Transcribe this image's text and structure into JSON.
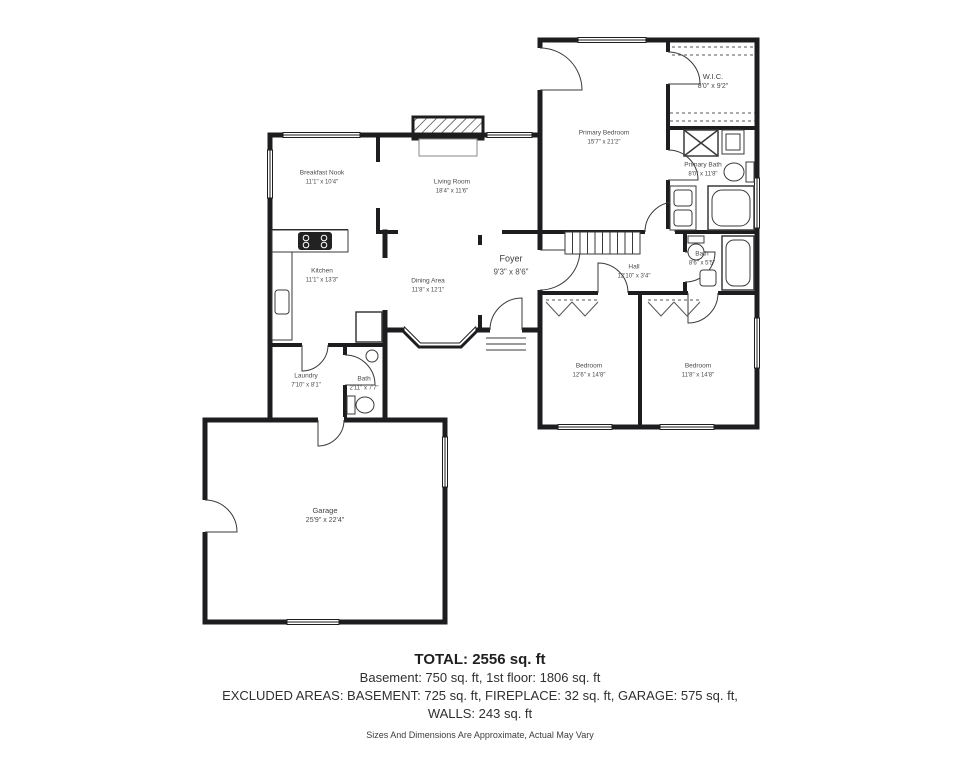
{
  "rooms": {
    "primary_bedroom": {
      "name": "Primary Bedroom",
      "dims": "15'7\" x 21'2\""
    },
    "wic": {
      "name": "W.I.C.",
      "dims": "8'0\" x 9'2\""
    },
    "primary_bath": {
      "name": "Primary Bath",
      "dims": "8'0\" x 11'8\""
    },
    "breakfast_nook": {
      "name": "Breakfast Nook",
      "dims": "11'1\" x 10'4\""
    },
    "living_room": {
      "name": "Living Room",
      "dims": "18'4\" x 11'6\""
    },
    "kitchen": {
      "name": "Kitchen",
      "dims": "11'1\" x 13'3\""
    },
    "dining_area": {
      "name": "Dining Area",
      "dims": "11'8\" x 12'1\""
    },
    "foyer": {
      "name": "Foyer",
      "dims": "9'3\" x 8'6\""
    },
    "hall": {
      "name": "Hall",
      "dims": "12'10\" x 3'4\""
    },
    "hall_bath": {
      "name": "Bath",
      "dims": "8'6\" x 5'5\""
    },
    "bedroom_center": {
      "name": "Bedroom",
      "dims": "12'6\" x 14'8\""
    },
    "bedroom_right": {
      "name": "Bedroom",
      "dims": "11'8\" x 14'8\""
    },
    "laundry": {
      "name": "Laundry",
      "dims": "7'10\" x 8'1\""
    },
    "small_bath": {
      "name": "Bath",
      "dims": "2'11\" x 7'7\""
    },
    "garage": {
      "name": "Garage",
      "dims": "25'9\" x 22'4\""
    }
  },
  "summary": {
    "total": "TOTAL: 2556 sq. ft",
    "floors": "Basement: 750 sq. ft, 1st floor: 1806 sq. ft",
    "excluded": "EXCLUDED AREAS: BASEMENT: 725 sq. ft, FIREPLACE: 32 sq. ft, GARAGE: 575 sq. ft,",
    "walls": "WALLS: 243 sq. ft",
    "disclaimer": "Sizes And Dimensions Are Approximate, Actual May Vary"
  },
  "colors": {
    "wall": "#1d1d1f",
    "background": "#ffffff",
    "label_text": "#4a4a4a"
  }
}
